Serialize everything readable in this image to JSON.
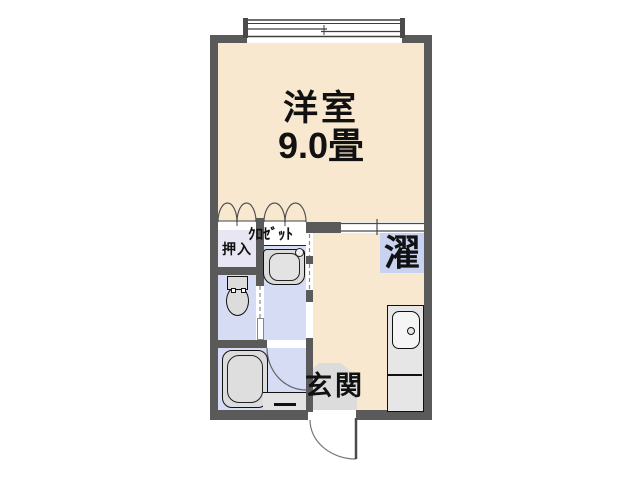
{
  "floorplan": {
    "labels": {
      "western_room": "洋室",
      "western_room_size": "9.0畳",
      "oshiire": "押入",
      "closet": "ｸﾛｾﾞｯﾄ",
      "laundry": "濯",
      "entrance": "玄関"
    },
    "colors": {
      "wall": "#5a5a5a",
      "flooring": "#f8e8cf",
      "wet_area": "#d6dcf4",
      "oshiire_fill": "#e8e6f2",
      "laundry_pan": "#c9d3f1",
      "entrance_floor": "#dcdcdc",
      "fixture": "#dcdcdc",
      "counter": "#e6e6e6"
    }
  }
}
